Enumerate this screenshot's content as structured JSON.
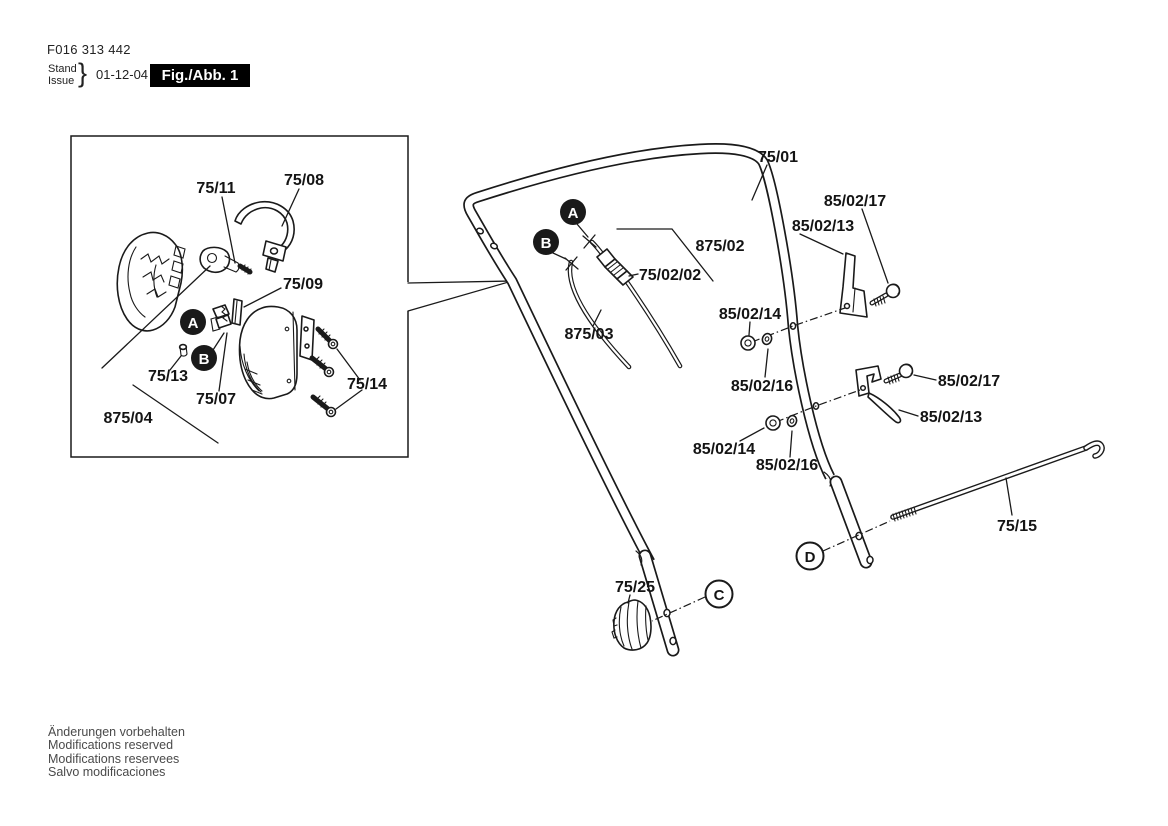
{
  "header": {
    "document_number": "F016 313 442",
    "stand": "Stand",
    "issue": "Issue",
    "date": "01-12-04",
    "figure": "Fig./Abb. 1"
  },
  "footer": {
    "line1": "Änderungen vorbehalten",
    "line2": "Modifications reserved",
    "line3": "Modifications reservees",
    "line4": "Salvo modificaciones"
  },
  "parts": {
    "p75_01": "75/01",
    "p75_02_02": "75/02/02",
    "p75_07": "75/07",
    "p75_08": "75/08",
    "p75_09": "75/09",
    "p75_11": "75/11",
    "p75_13": "75/13",
    "p75_14": "75/14",
    "p75_15": "75/15",
    "p75_25": "75/25",
    "p875_02": "875/02",
    "p875_03": "875/03",
    "p875_04": "875/04",
    "p85_02_13": "85/02/13",
    "p85_02_14": "85/02/14",
    "p85_02_16": "85/02/16",
    "p85_02_17": "85/02/17"
  },
  "badges": {
    "a": "A",
    "b": "B",
    "c": "C",
    "d": "D"
  },
  "colors": {
    "ink": "#1a1a1a",
    "paper": "#ffffff",
    "figure_box_bg": "#000000",
    "figure_box_text": "#ffffff"
  }
}
